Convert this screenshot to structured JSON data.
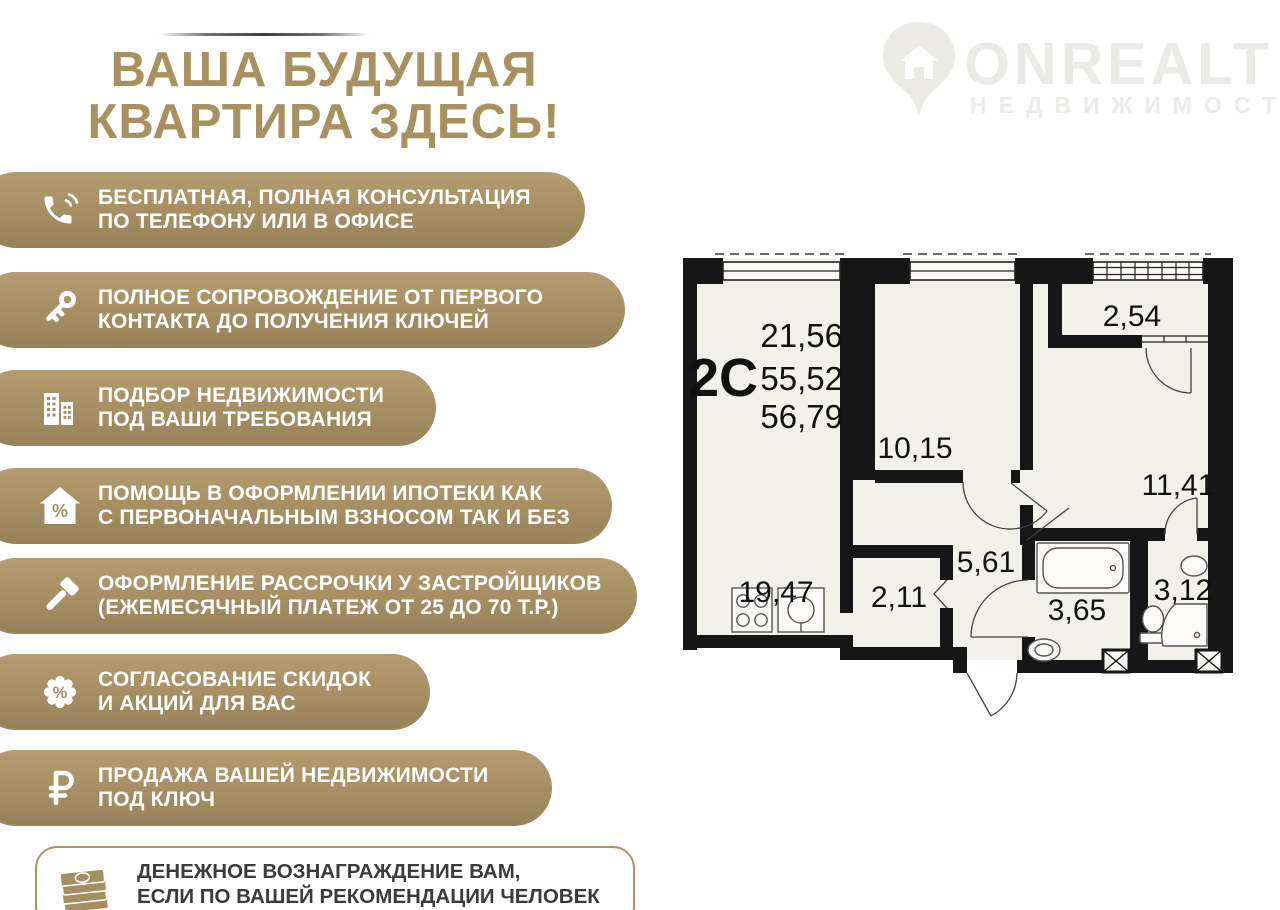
{
  "brand": {
    "logo_text": "ONREALT",
    "logo_sub": "НЕДВИЖИМОСТЬ"
  },
  "header": {
    "line1": "ВАША БУДУЩАЯ",
    "line2": "КВАРТИРА ЗДЕСЬ!"
  },
  "benefits": [
    {
      "icon": "phone-icon",
      "line1": "БЕСПЛАТНАЯ, ПОЛНАЯ КОНСУЛЬТАЦИЯ",
      "line2": "ПО ТЕЛЕФОНУ ИЛИ В ОФИСЕ"
    },
    {
      "icon": "key-icon",
      "line1": "ПОЛНОЕ СОПРОВОЖДЕНИЕ ОТ ПЕРВОГО",
      "line2": "КОНТАКТА ДО ПОЛУЧЕНИЯ КЛЮЧЕЙ"
    },
    {
      "icon": "buildings-icon",
      "line1": "ПОДБОР НЕДВИЖИМОСТИ",
      "line2": "ПОД ВАШИ ТРЕБОВАНИЯ"
    },
    {
      "icon": "house-percent-icon",
      "line1": "ПОМОЩЬ В ОФОРМЛЕНИИ ИПОТЕКИ КАК",
      "line2": "С ПЕРВОНАЧАЛЬНЫМ ВЗНОСОМ ТАК И БЕЗ"
    },
    {
      "icon": "hammer-icon",
      "line1": "ОФОРМЛЕНИЕ РАССРОЧКИ У ЗАСТРОЙЩИКОВ",
      "line2": "(ЕЖЕМЕСЯЧНЫЙ ПЛАТЕЖ ОТ 25 ДО 70 Т.Р.)"
    },
    {
      "icon": "percent-badge-icon",
      "line1": "СОГЛАСОВАНИЕ СКИДОК",
      "line2": "И АКЦИЙ ДЛЯ ВАС"
    },
    {
      "icon": "ruble-icon",
      "line1": "ПРОДАЖА ВАШЕЙ НЕДВИЖИМОСТИ",
      "line2": "ПОД КЛЮЧ"
    }
  ],
  "footer_note": {
    "icon": "money-stack-icon",
    "line1": "ДЕНЕЖНОЕ ВОЗНАГРАЖДЕНИЕ ВАМ,",
    "line2": "ЕСЛИ ПО ВАШЕЙ РЕКОМЕНДАЦИИ ЧЕЛОВЕК"
  },
  "floor_plan": {
    "type_label": "2С",
    "areas": [
      "21,56",
      "55,52",
      "56,79"
    ],
    "room_areas": {
      "kitchen_living": "19,47",
      "bedroom1": "10,15",
      "balcony": "2,54",
      "bedroom2": "11,41",
      "hall": "5,61",
      "wardrobe": "2,11",
      "bathroom": "3,65",
      "toilet": "3,12"
    }
  },
  "colors": {
    "accent_gold": "#a8915f",
    "banner_gold": "#a48e62",
    "wall_black": "#161616",
    "room_fill": "#f3f1ec",
    "watermark": "#eceae7",
    "text_dark": "#3b3b3b"
  }
}
